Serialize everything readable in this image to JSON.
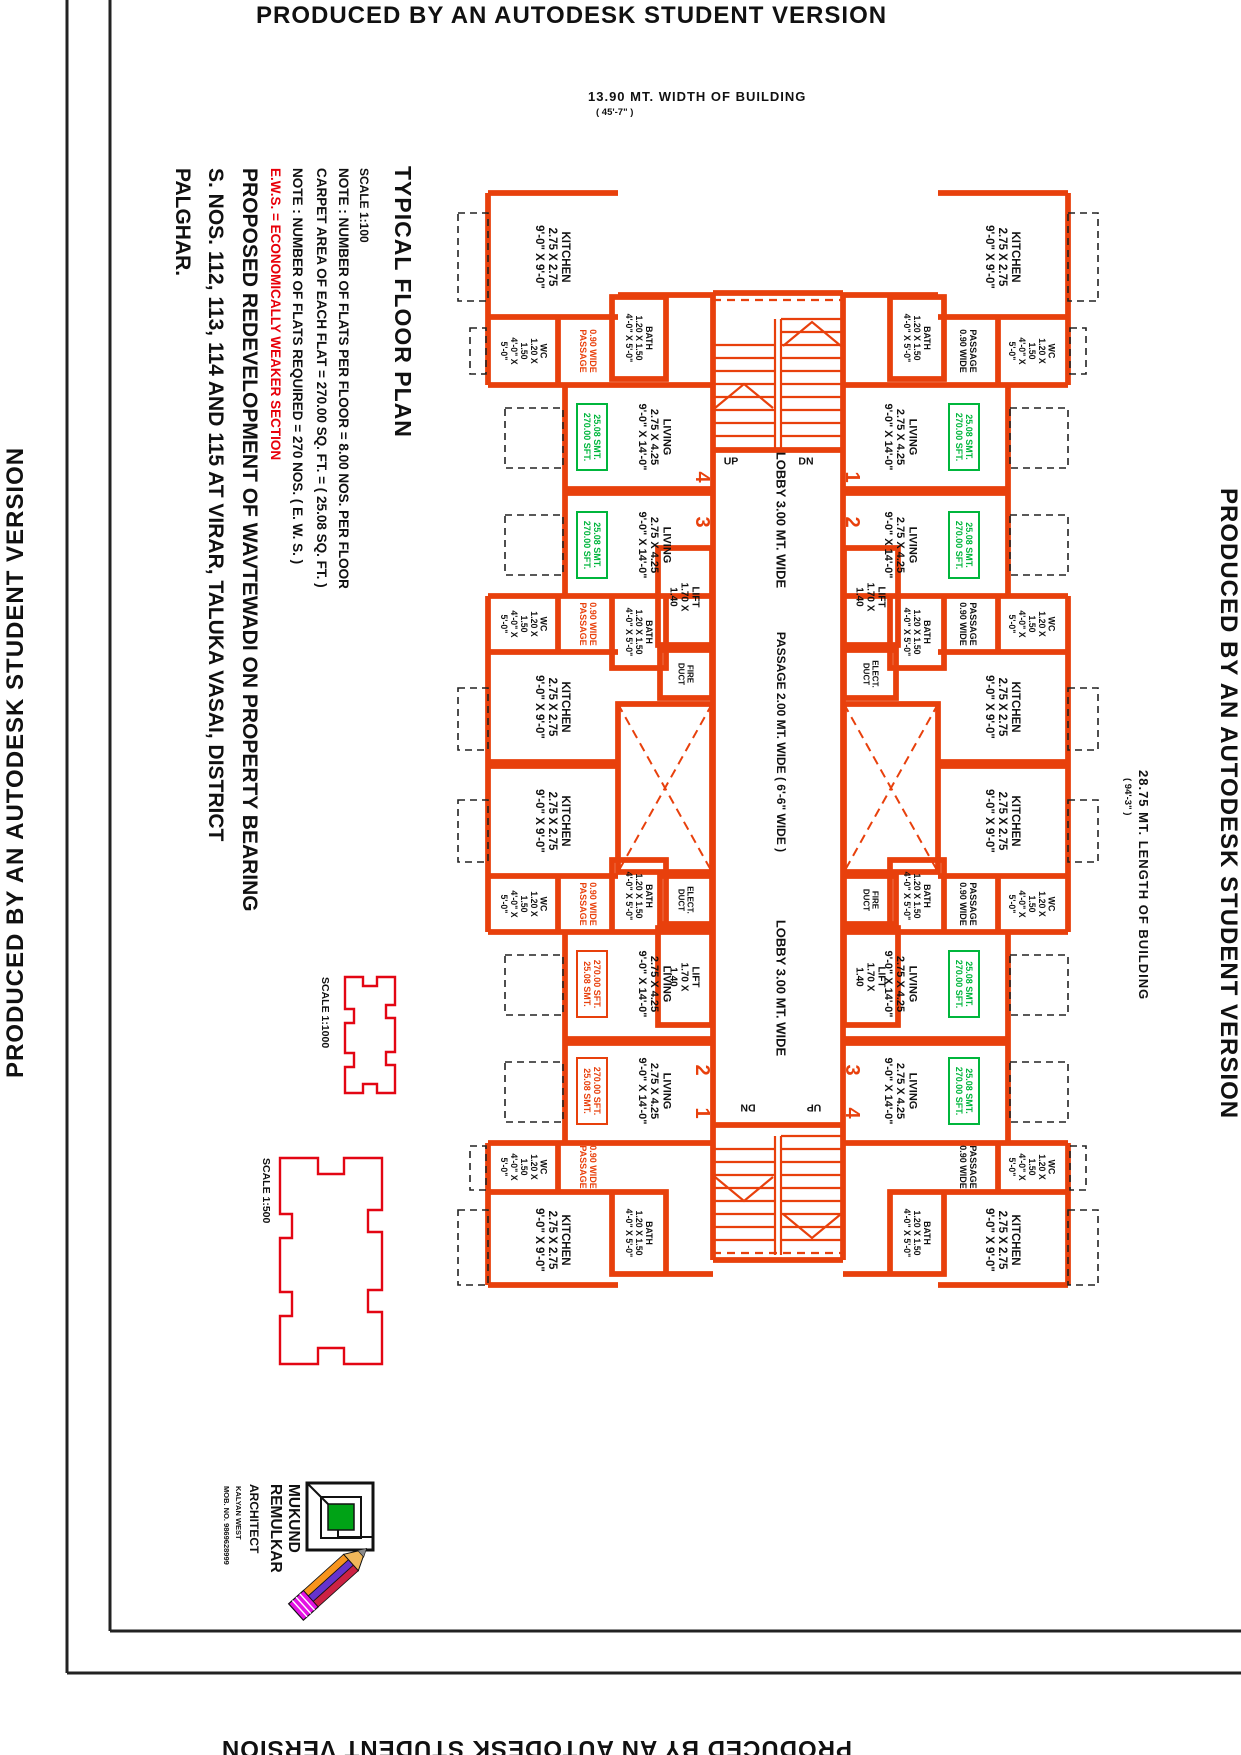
{
  "banner": {
    "text": "PRODUCED BY AN AUTODESK STUDENT VERSION"
  },
  "dimensions": {
    "width_label": "13.90  MT. WIDTH  OF  BUILDING",
    "width_ft": "( 45'-7\" )",
    "length_label": "28.75  MT.  LENGTH  OF  BUILDING",
    "length_ft": "( 94'-3\" )"
  },
  "title_block": {
    "title": "TYPICAL FLOOR PLAN",
    "scale": "SCALE  1:100",
    "note1": "NOTE : NUMBER OF FLATS PER FLOOR = 8.00 NOS. PER FLOOR",
    "note2": "CARPET AREA OF EACH FLAT = 270.00 SQ. FT. = ( 25.08 SQ. FT. )",
    "note3": "NOTE : NUMBER OF FLATS REQUIRED =  270 NOS. ( E. W. S. )",
    "note4": "E.W.S.  =  ECONOMICALLY WEAKER SECTION",
    "project1": "PROPOSED  REDEVELOPMENT  OF  WAVTEWADI  ON  PROPERTY  BEARING",
    "project2": "S. NOS. 112, 113, 114  AND  115  AT  VIRAR,  TALUKA  VASAI,  DISTRICT",
    "project3": "PALGHAR."
  },
  "key_plans": {
    "kp1_scale": "SCALE  1:1000",
    "kp2_scale": "SCALE  1:500"
  },
  "stamp": {
    "name1": "MUKUND",
    "name2": "REMULKAR",
    "title": "ARCHITECT",
    "line1": "KALYAN WEST",
    "line2": "MOB. NO. 9869628999"
  },
  "colors": {
    "wall": "#e8400c",
    "keyplan_red": "#e30613",
    "area_green": "#00b63c",
    "note_red": "#e8000a",
    "text_black": "#111111",
    "logo_green": "#00a316",
    "pencil_magenta": "#e312e3",
    "pencil_orange": "#f7941d",
    "pencil_purple": "#6633cc",
    "pencil_crimson": "#cc2244"
  },
  "plan": {
    "label_defs": {
      "kitchen": [
        "KITCHEN",
        "2.75 X 2.75",
        "9'-0\" X 9'-0\""
      ],
      "living": [
        "LIVING",
        "2.75 X 4.25",
        "9'-0\" X 14'-0\""
      ],
      "wc": [
        "WC",
        "1.20 X",
        "1.50",
        "4'-0\" X",
        "5'-0\""
      ],
      "bath": [
        "BATH",
        "1.20 X 1.50",
        "4'-0\" X 5'-0\""
      ],
      "lift": [
        "LIFT",
        "1.70 X",
        "1.40"
      ],
      "fire_duct": [
        "FIRE",
        "DUCT"
      ],
      "elect_duct": [
        "ELECT.",
        "DUCT"
      ],
      "passage_red": [
        "0.90 WIDE",
        "PASSAGE"
      ],
      "passage_blk": [
        "PASSAGE",
        "0.90 WIDE"
      ],
      "area_green": [
        "25.08 SMT.",
        "270.00 SFT."
      ],
      "area_red": [
        "270.00 SFT.",
        "25.08 SMT."
      ],
      "lobby": [
        "LOBBY  3.00 MT.  WIDE"
      ],
      "passage_core": [
        "PASSAGE  2.00  MT.  WIDE  ( 6'-6\" WIDE )"
      ]
    },
    "texts": [
      {
        "name": "kitchen-label",
        "x": 553,
        "y": 257,
        "rot": 90,
        "size": 11.5,
        "color": "#111",
        "ref": "kitchen"
      },
      {
        "name": "wc-label",
        "x": 524,
        "y": 351,
        "rot": 90,
        "size": 8.8,
        "color": "#111",
        "ref": "wc"
      },
      {
        "name": "passage-label",
        "x": 588,
        "y": 351,
        "rot": 90,
        "size": 9,
        "color": "#e8400c",
        "ref": "passage_red"
      },
      {
        "name": "bath-label",
        "x": 639,
        "y": 338,
        "rot": 90,
        "size": 8.8,
        "color": "#111",
        "ref": "bath"
      },
      {
        "name": "living-label",
        "x": 655,
        "y": 437,
        "rot": 90,
        "size": 11,
        "color": "#111",
        "ref": "living"
      },
      {
        "name": "area-badge-green",
        "x": 592,
        "y": 437,
        "rot": 90,
        "size": 9,
        "color": "#00b63c",
        "ref": "area_green",
        "box": {
          "w": 66,
          "h": 30
        }
      },
      {
        "name": "living-label",
        "x": 655,
        "y": 545,
        "rot": 90,
        "size": 11,
        "color": "#111",
        "ref": "living"
      },
      {
        "name": "area-badge-green",
        "x": 592,
        "y": 545,
        "rot": 90,
        "size": 9,
        "color": "#00b63c",
        "ref": "area_green",
        "box": {
          "w": 66,
          "h": 30
        }
      },
      {
        "name": "flat-number",
        "x": 703,
        "y": 477,
        "rot": 90,
        "size": 20,
        "color": "#e8400c",
        "lines": [
          "4"
        ]
      },
      {
        "name": "flat-number",
        "x": 703,
        "y": 522,
        "rot": 90,
        "size": 20,
        "color": "#e8400c",
        "lines": [
          "3"
        ]
      },
      {
        "name": "lift-label",
        "x": 685,
        "y": 597,
        "rot": 90,
        "size": 10,
        "color": "#111",
        "ref": "lift"
      },
      {
        "name": "fire-duct-label",
        "x": 686,
        "y": 674,
        "rot": 90,
        "size": 8,
        "color": "#111",
        "ref": "fire_duct"
      },
      {
        "name": "wc-label",
        "x": 524,
        "y": 624,
        "rot": 90,
        "size": 8.8,
        "color": "#111",
        "ref": "wc"
      },
      {
        "name": "passage-label",
        "x": 588,
        "y": 624,
        "rot": 90,
        "size": 9,
        "color": "#e8400c",
        "ref": "passage_red"
      },
      {
        "name": "bath-label",
        "x": 639,
        "y": 632,
        "rot": 90,
        "size": 8.8,
        "color": "#111",
        "ref": "bath"
      },
      {
        "name": "kitchen-label",
        "x": 553,
        "y": 707,
        "rot": 90,
        "size": 11.5,
        "color": "#111",
        "ref": "kitchen"
      },
      {
        "name": "kitchen-label",
        "x": 553,
        "y": 821,
        "rot": 90,
        "size": 11.5,
        "color": "#111",
        "ref": "kitchen"
      },
      {
        "name": "wc-label",
        "x": 524,
        "y": 904,
        "rot": 90,
        "size": 8.8,
        "color": "#111",
        "ref": "wc"
      },
      {
        "name": "passage-label",
        "x": 588,
        "y": 904,
        "rot": 90,
        "size": 9,
        "color": "#e8400c",
        "ref": "passage_red"
      },
      {
        "name": "bath-label",
        "x": 639,
        "y": 896,
        "rot": 90,
        "size": 8.8,
        "color": "#111",
        "ref": "bath"
      },
      {
        "name": "elect-duct-label",
        "x": 686,
        "y": 900,
        "rot": 90,
        "size": 8,
        "color": "#111",
        "ref": "elect_duct"
      },
      {
        "name": "lift-label",
        "x": 685,
        "y": 977,
        "rot": 90,
        "size": 10,
        "color": "#111",
        "ref": "lift"
      },
      {
        "name": "living-label",
        "x": 655,
        "y": 984,
        "rot": 90,
        "size": 11,
        "color": "#111",
        "ref": "living"
      },
      {
        "name": "area-badge-red",
        "x": 592,
        "y": 984,
        "rot": 90,
        "size": 9,
        "color": "#e8400c",
        "ref": "area_red",
        "box": {
          "w": 66,
          "h": 30
        }
      },
      {
        "name": "living-label",
        "x": 655,
        "y": 1091,
        "rot": 90,
        "size": 11,
        "color": "#111",
        "ref": "living"
      },
      {
        "name": "area-badge-red",
        "x": 592,
        "y": 1091,
        "rot": 90,
        "size": 9,
        "color": "#e8400c",
        "ref": "area_red",
        "box": {
          "w": 66,
          "h": 30
        }
      },
      {
        "name": "flat-number",
        "x": 703,
        "y": 1070,
        "rot": 90,
        "size": 20,
        "color": "#e8400c",
        "lines": [
          "2"
        ]
      },
      {
        "name": "flat-number",
        "x": 703,
        "y": 1113,
        "rot": 90,
        "size": 20,
        "color": "#e8400c",
        "lines": [
          "1"
        ]
      },
      {
        "name": "wc-label",
        "x": 524,
        "y": 1167,
        "rot": 90,
        "size": 8.8,
        "color": "#111",
        "ref": "wc"
      },
      {
        "name": "passage-label",
        "x": 588,
        "y": 1167,
        "rot": 90,
        "size": 9,
        "color": "#e8400c",
        "ref": "passage_red"
      },
      {
        "name": "bath-label",
        "x": 639,
        "y": 1233,
        "rot": 90,
        "size": 8.8,
        "color": "#111",
        "ref": "bath"
      },
      {
        "name": "kitchen-label",
        "x": 553,
        "y": 1240,
        "rot": 90,
        "size": 11.5,
        "color": "#111",
        "ref": "kitchen"
      },
      {
        "name": "kitchen-label",
        "x": 1003,
        "y": 257,
        "rot": 90,
        "size": 11.5,
        "color": "#111",
        "ref": "kitchen"
      },
      {
        "name": "wc-label",
        "x": 1032,
        "y": 351,
        "rot": 90,
        "size": 8.8,
        "color": "#111",
        "ref": "wc"
      },
      {
        "name": "passage-label",
        "x": 968,
        "y": 351,
        "rot": 90,
        "size": 9,
        "color": "#111",
        "ref": "passage_blk"
      },
      {
        "name": "bath-label",
        "x": 917,
        "y": 338,
        "rot": 90,
        "size": 8.8,
        "color": "#111",
        "ref": "bath"
      },
      {
        "name": "living-label",
        "x": 901,
        "y": 437,
        "rot": 90,
        "size": 11,
        "color": "#111",
        "ref": "living"
      },
      {
        "name": "area-badge-green",
        "x": 964,
        "y": 437,
        "rot": 90,
        "size": 9,
        "color": "#00b63c",
        "ref": "area_green",
        "box": {
          "w": 66,
          "h": 30
        }
      },
      {
        "name": "living-label",
        "x": 901,
        "y": 545,
        "rot": 90,
        "size": 11,
        "color": "#111",
        "ref": "living"
      },
      {
        "name": "area-badge-green",
        "x": 964,
        "y": 545,
        "rot": 90,
        "size": 9,
        "color": "#00b63c",
        "ref": "area_green",
        "box": {
          "w": 66,
          "h": 30
        }
      },
      {
        "name": "flat-number",
        "x": 853,
        "y": 477,
        "rot": 90,
        "size": 20,
        "color": "#e8400c",
        "lines": [
          "1"
        ]
      },
      {
        "name": "flat-number",
        "x": 853,
        "y": 522,
        "rot": 90,
        "size": 20,
        "color": "#e8400c",
        "lines": [
          "2"
        ]
      },
      {
        "name": "lift-label",
        "x": 871,
        "y": 597,
        "rot": 90,
        "size": 10,
        "color": "#111",
        "ref": "lift"
      },
      {
        "name": "elect-duct-label",
        "x": 871,
        "y": 674,
        "rot": 90,
        "size": 8,
        "color": "#111",
        "ref": "elect_duct"
      },
      {
        "name": "wc-label",
        "x": 1032,
        "y": 624,
        "rot": 90,
        "size": 8.8,
        "color": "#111",
        "ref": "wc"
      },
      {
        "name": "passage-label",
        "x": 968,
        "y": 624,
        "rot": 90,
        "size": 9,
        "color": "#111",
        "ref": "passage_blk"
      },
      {
        "name": "bath-label",
        "x": 917,
        "y": 632,
        "rot": 90,
        "size": 8.8,
        "color": "#111",
        "ref": "bath"
      },
      {
        "name": "kitchen-label",
        "x": 1003,
        "y": 707,
        "rot": 90,
        "size": 11.5,
        "color": "#111",
        "ref": "kitchen"
      },
      {
        "name": "kitchen-label",
        "x": 1003,
        "y": 821,
        "rot": 90,
        "size": 11.5,
        "color": "#111",
        "ref": "kitchen"
      },
      {
        "name": "wc-label",
        "x": 1032,
        "y": 904,
        "rot": 90,
        "size": 8.8,
        "color": "#111",
        "ref": "wc"
      },
      {
        "name": "passage-label",
        "x": 968,
        "y": 904,
        "rot": 90,
        "size": 9,
        "color": "#111",
        "ref": "passage_blk"
      },
      {
        "name": "bath-label",
        "x": 917,
        "y": 896,
        "rot": 90,
        "size": 8.8,
        "color": "#111",
        "ref": "bath"
      },
      {
        "name": "fire-duct-label",
        "x": 871,
        "y": 900,
        "rot": 90,
        "size": 8,
        "color": "#111",
        "ref": "fire_duct"
      },
      {
        "name": "lift-label",
        "x": 871,
        "y": 977,
        "rot": 90,
        "size": 10,
        "color": "#111",
        "ref": "lift"
      },
      {
        "name": "living-label",
        "x": 901,
        "y": 984,
        "rot": 90,
        "size": 11,
        "color": "#111",
        "ref": "living"
      },
      {
        "name": "area-badge-green",
        "x": 964,
        "y": 984,
        "rot": 90,
        "size": 9,
        "color": "#00b63c",
        "ref": "area_green",
        "box": {
          "w": 66,
          "h": 30
        }
      },
      {
        "name": "living-label",
        "x": 901,
        "y": 1091,
        "rot": 90,
        "size": 11,
        "color": "#111",
        "ref": "living"
      },
      {
        "name": "area-badge-green",
        "x": 964,
        "y": 1091,
        "rot": 90,
        "size": 9,
        "color": "#00b63c",
        "ref": "area_green",
        "box": {
          "w": 66,
          "h": 30
        }
      },
      {
        "name": "flat-number",
        "x": 853,
        "y": 1070,
        "rot": 90,
        "size": 20,
        "color": "#e8400c",
        "lines": [
          "3"
        ]
      },
      {
        "name": "flat-number",
        "x": 853,
        "y": 1113,
        "rot": 90,
        "size": 20,
        "color": "#e8400c",
        "lines": [
          "4"
        ]
      },
      {
        "name": "wc-label",
        "x": 1032,
        "y": 1167,
        "rot": 90,
        "size": 8.8,
        "color": "#111",
        "ref": "wc"
      },
      {
        "name": "passage-label",
        "x": 968,
        "y": 1167,
        "rot": 90,
        "size": 9,
        "color": "#111",
        "ref": "passage_blk"
      },
      {
        "name": "bath-label",
        "x": 917,
        "y": 1233,
        "rot": 90,
        "size": 8.8,
        "color": "#111",
        "ref": "bath"
      },
      {
        "name": "kitchen-label",
        "x": 1003,
        "y": 1240,
        "rot": 90,
        "size": 11.5,
        "color": "#111",
        "ref": "kitchen"
      },
      {
        "name": "lobby-label",
        "x": 781,
        "y": 520,
        "rot": 90,
        "size": 13,
        "color": "#111",
        "ref": "lobby"
      },
      {
        "name": "passage-core-label",
        "x": 781,
        "y": 742,
        "rot": 90,
        "size": 12,
        "color": "#111",
        "ref": "passage_core"
      },
      {
        "name": "lobby-label",
        "x": 781,
        "y": 988,
        "rot": 90,
        "size": 13,
        "color": "#111",
        "ref": "lobby"
      },
      {
        "name": "stair-up-label",
        "x": 731,
        "y": 461,
        "rot": 0,
        "size": 10.5,
        "color": "#111",
        "lines": [
          "UP"
        ]
      },
      {
        "name": "stair-dn-label",
        "x": 806,
        "y": 461,
        "rot": 0,
        "size": 10.5,
        "color": "#111",
        "lines": [
          "DN"
        ]
      },
      {
        "name": "stair-dn-label",
        "x": 748,
        "y": 1108,
        "rot": 180,
        "size": 10.5,
        "color": "#111",
        "lines": [
          "DN"
        ]
      },
      {
        "name": "stair-up-label",
        "x": 814,
        "y": 1108,
        "rot": 180,
        "size": 10.5,
        "color": "#111",
        "lines": [
          "UP"
        ]
      }
    ]
  }
}
